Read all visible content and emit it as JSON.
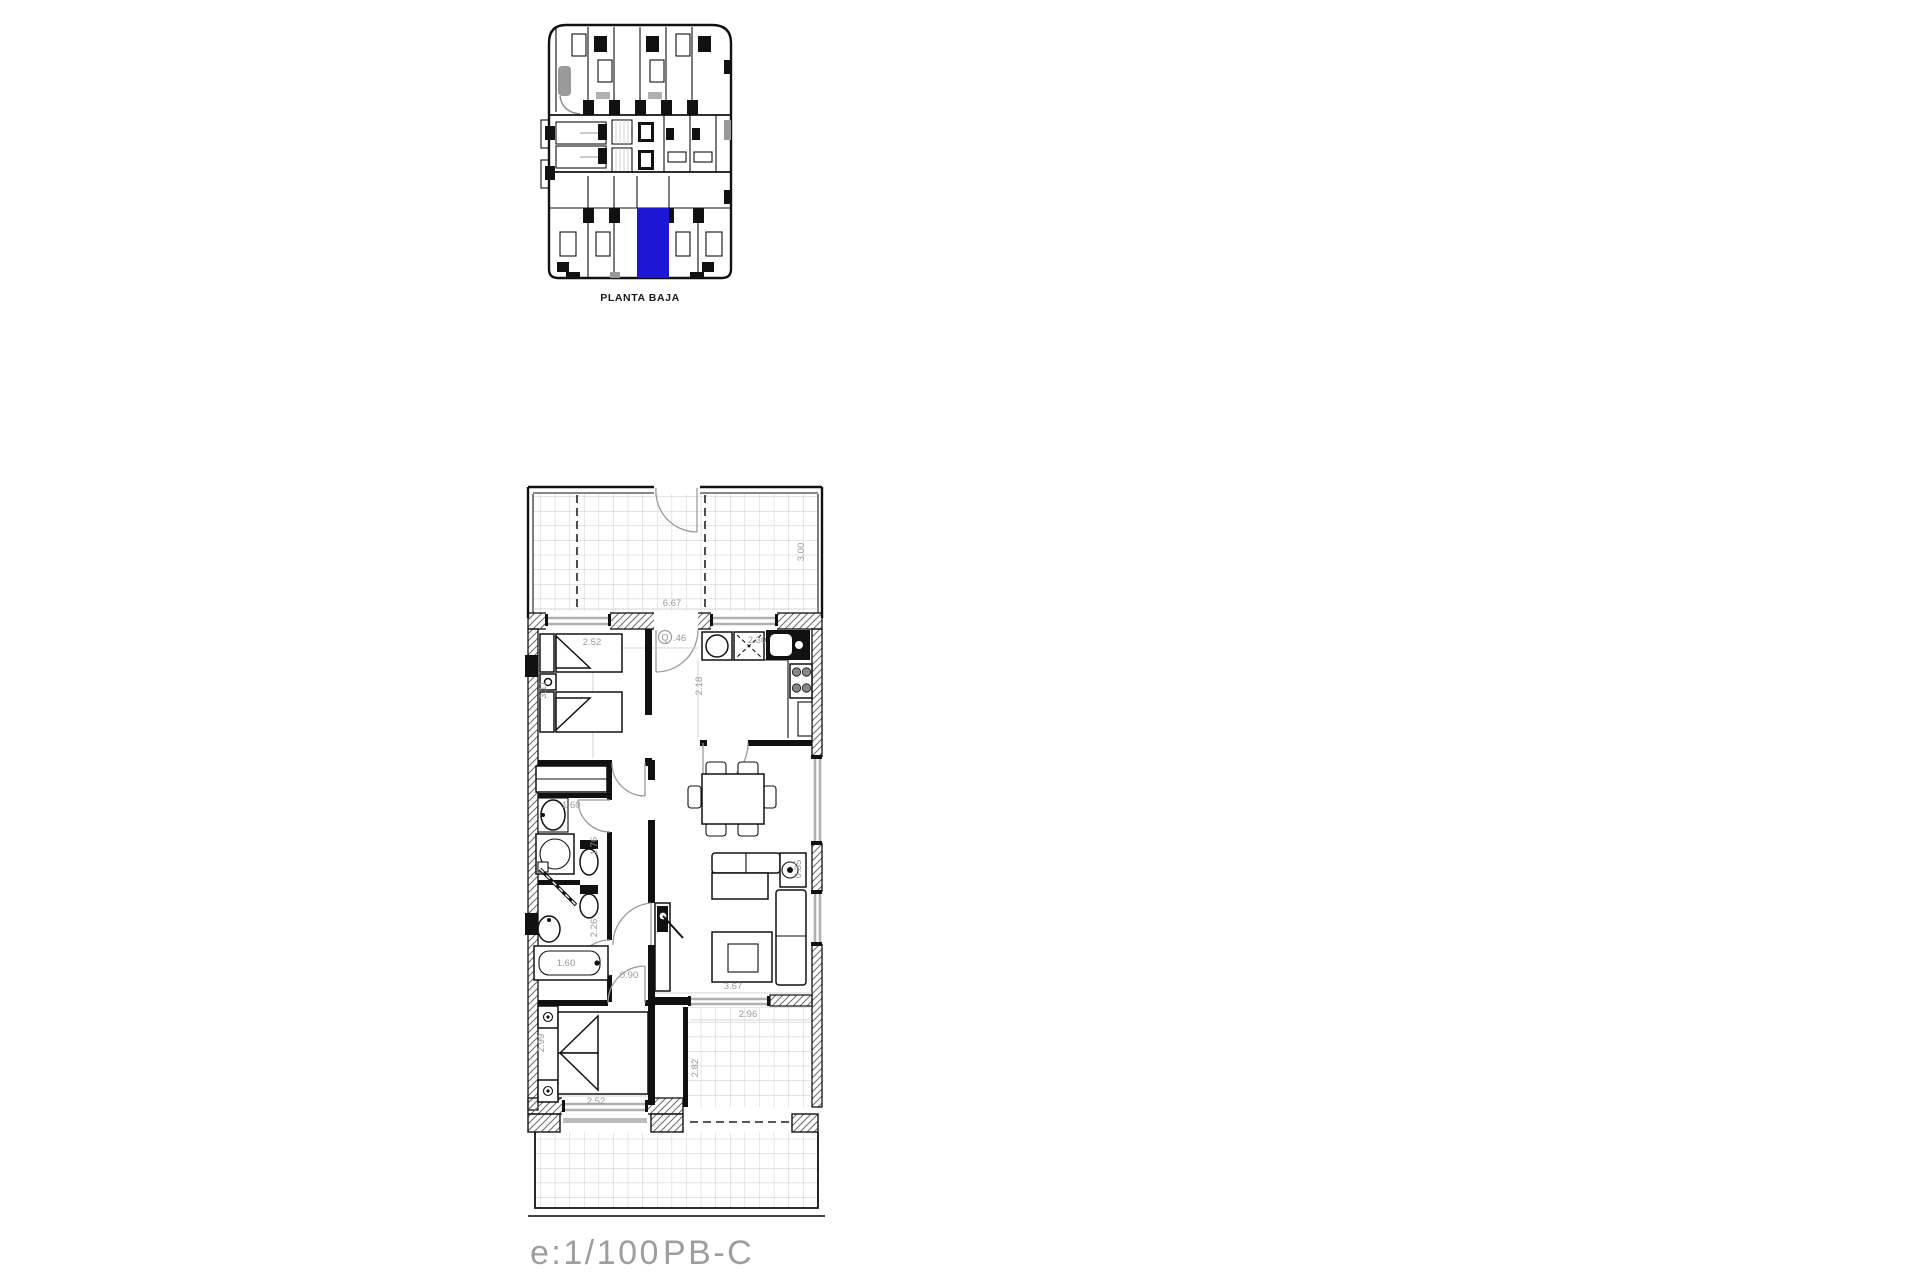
{
  "overview": {
    "label": "PLANTA BAJA",
    "highlight_color": "#1c17d6"
  },
  "plan": {
    "footer": {
      "scale": "e:1/100",
      "unit": "PB-C"
    },
    "labels": {
      "terrace_width": "6.67",
      "terrace_depth": "3.00",
      "bedroom1_width": "2.52",
      "bedroom1_depth": "3.11",
      "entry_symbol": "Q",
      "entry_width": ".46",
      "hall_depth": "2.18",
      "kitchen_width": "2.30",
      "bath1_basin": "1.60",
      "bath1_depth": "1.76",
      "bath2_depth": "2.26",
      "bathtub_length": "1.60",
      "corridor_width": "0.90",
      "living_width": "3.67",
      "side_table": "0.35",
      "bedroom2_width": "2.52",
      "bedroom2_depth": "2.99",
      "terrace2_width": "2.96",
      "terrace2_depth": "2.82"
    }
  }
}
